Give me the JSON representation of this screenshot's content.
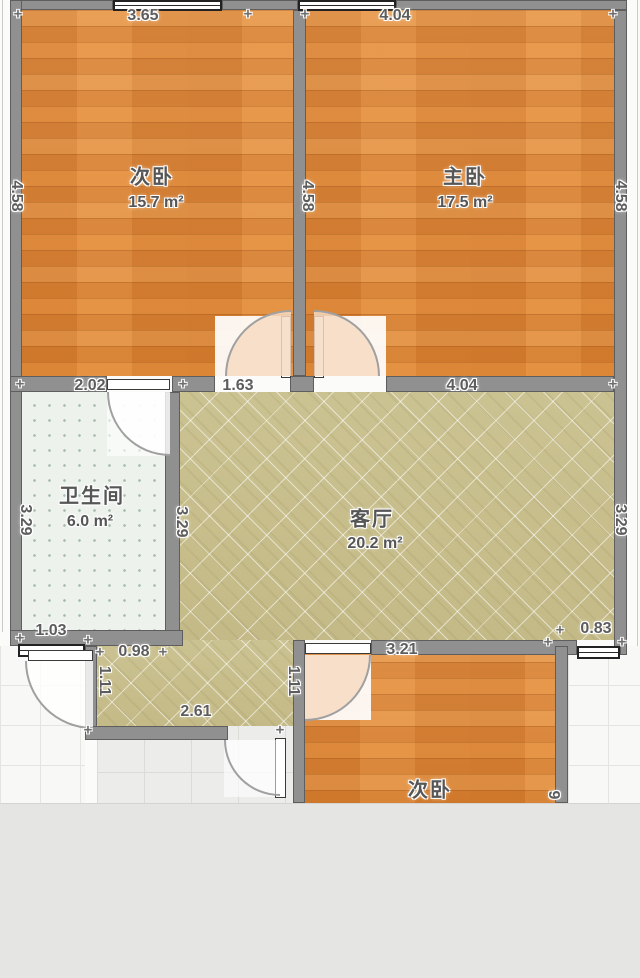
{
  "plan": {
    "rooms": {
      "bedroom_top_left": {
        "name": "次卧",
        "area": "15.7 m²"
      },
      "bedroom_top_right": {
        "name": "主卧",
        "area": "17.5 m²"
      },
      "bathroom": {
        "name": "卫生间",
        "area": "6.0 m²"
      },
      "living_room": {
        "name": "客厅",
        "area": "20.2 m²"
      },
      "bedroom_bottom": {
        "name": "次卧"
      }
    },
    "dimensions": {
      "bedroom_tl_width": "3.65",
      "bedroom_tr_width": "4.04",
      "left_wall_height": "4.58",
      "middle_wall_height": "4.58",
      "right_wall_height": "4.58",
      "bathroom_width": "2.02",
      "hall_gap_width": "1.63",
      "living_width": "4.04",
      "bathroom_left_height": "3.29",
      "bathroom_right_height": "3.29",
      "living_right_height": "3.29",
      "bathroom_bottom_width": "1.03",
      "entry_top_width": "0.98",
      "entry_left_height": "1.11",
      "entry_right_height": "1.11",
      "entry_bottom_width": "2.61",
      "bedroom_bottom_width": "3.21",
      "right_offset_width": "0.83",
      "bedroom_bottom_height_partial": "9"
    },
    "colors": {
      "wood_floor": "#df8a3e",
      "living_floor": "#c9c08f",
      "bathroom_floor": "#edf2ed",
      "wall": "#909090",
      "outside_tile": "#f8f8f6",
      "entry_tile": "#ececea",
      "cropped_band": "#e5e5e3",
      "label_text": "#5d5d5d"
    },
    "ticks": [
      {
        "x": 18,
        "y": 14
      },
      {
        "x": 248,
        "y": 14
      },
      {
        "x": 305,
        "y": 14
      },
      {
        "x": 613,
        "y": 14
      },
      {
        "x": 20,
        "y": 384
      },
      {
        "x": 183,
        "y": 384
      },
      {
        "x": 613,
        "y": 384
      },
      {
        "x": 20,
        "y": 638
      },
      {
        "x": 88,
        "y": 640
      },
      {
        "x": 100,
        "y": 652
      },
      {
        "x": 163,
        "y": 652
      },
      {
        "x": 88,
        "y": 730
      },
      {
        "x": 280,
        "y": 730
      },
      {
        "x": 548,
        "y": 642
      },
      {
        "x": 622,
        "y": 642
      },
      {
        "x": 560,
        "y": 630
      }
    ],
    "tick_glyph": "+"
  }
}
